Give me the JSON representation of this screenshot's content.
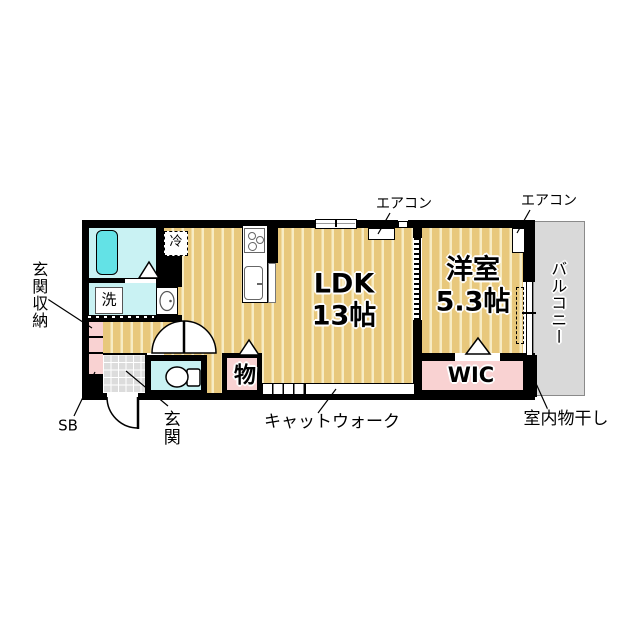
{
  "colors": {
    "wall": "#000000",
    "floor_tan": "#e8c87c",
    "floor_stripe": "#f7ecc4",
    "water": "#c9f2f3",
    "bathtub": "#63e2e6",
    "pink": "#f9d2d2",
    "tile": "#dcdcdc",
    "balcony": "#d9d9d9"
  },
  "rooms": {
    "ldk": {
      "label": "LDK",
      "size": "13帖"
    },
    "western": {
      "label": "洋室",
      "size": "5.3帖"
    },
    "wic": {
      "label": "WIC"
    },
    "balcony": {
      "label": "バルコニー"
    },
    "storage": {
      "label": "物"
    },
    "laundry": {
      "label": "洗"
    },
    "fridge": {
      "label": "冷"
    },
    "entrance": {
      "label": "玄関"
    },
    "entrance_storage": {
      "label": "玄関収納"
    },
    "shoe_box": {
      "label": "SB"
    }
  },
  "annotations": {
    "aircon_ldk": "エアコン",
    "aircon_western": "エアコン",
    "catwalk": "キャットウォーク",
    "indoor_drying": "室内物干し"
  }
}
